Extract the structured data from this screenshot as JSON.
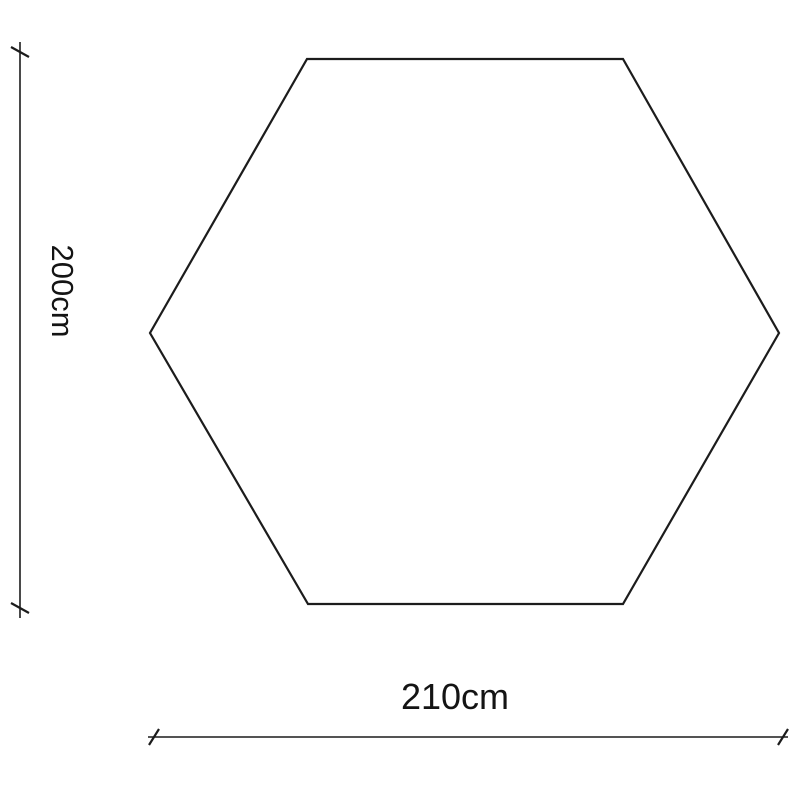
{
  "diagram": {
    "shape": "hexagon",
    "height_label": "200cm",
    "width_label": "210cm"
  },
  "colors": {
    "line": "#1c1c1c",
    "text": "#141414",
    "background": "#ffffff"
  }
}
